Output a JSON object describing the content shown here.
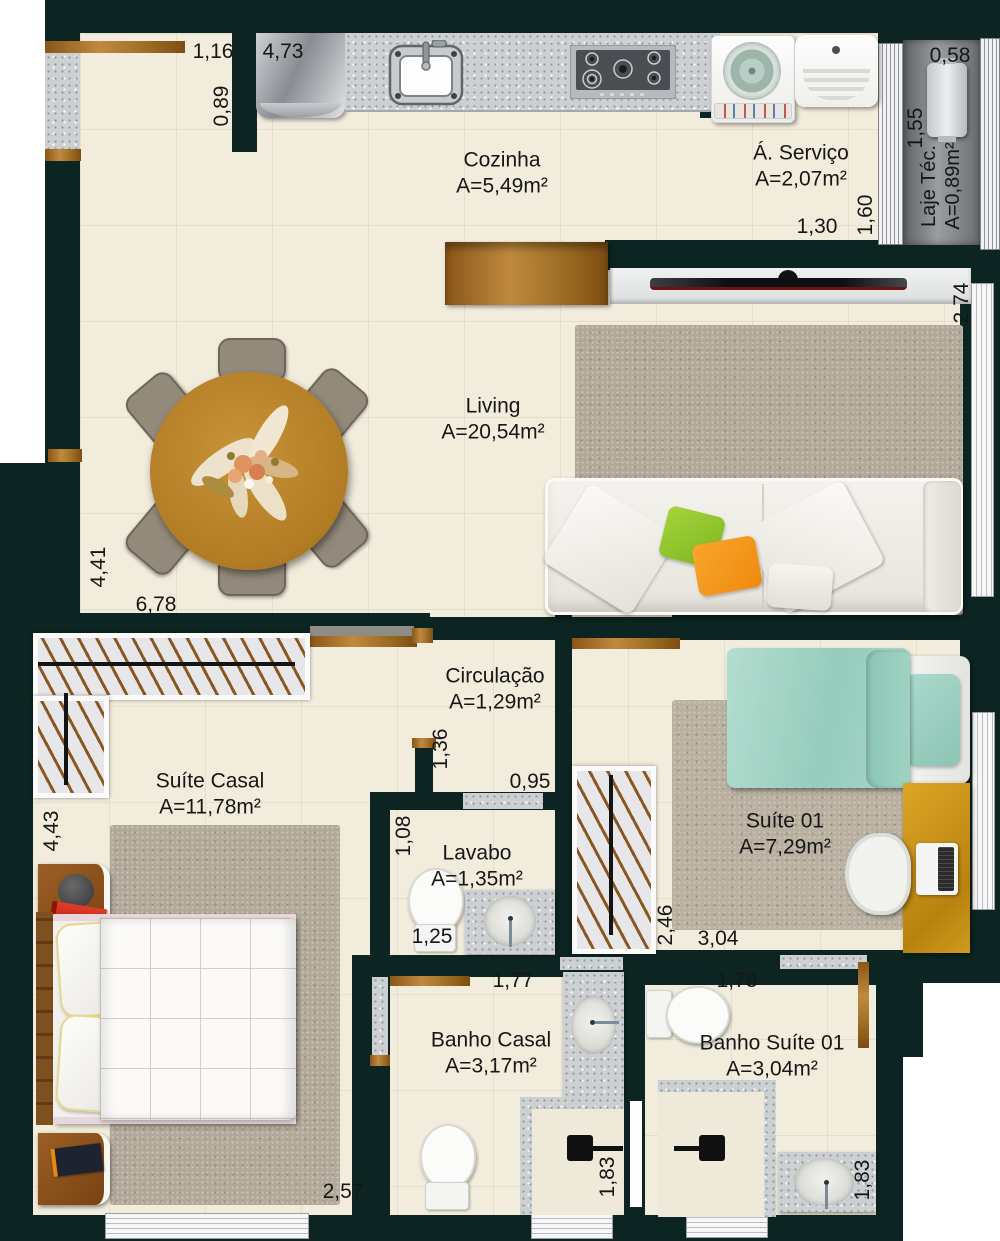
{
  "plan_title": "Apartment floor plan",
  "colors": {
    "wall": "#0c2522",
    "floor": "#f2ecdc",
    "granite": "#ccd0d3",
    "wood": "#b5832f",
    "teal_bed": "#a3d4c7",
    "rug": "#b2a99a",
    "pillow_green": "#95c42e",
    "pillow_orange": "#f49a1b"
  },
  "rooms": [
    {
      "name": "Cozinha",
      "area": "A=5,49m²"
    },
    {
      "name": "Á. Serviço",
      "area": "A=2,07m²"
    },
    {
      "name": "Laje Téc.",
      "area": "A=0,89m²"
    },
    {
      "name": "Living",
      "area": "A=20,54m²"
    },
    {
      "name": "Circulação",
      "area": "A=1,29m²"
    },
    {
      "name": "Suíte Casal",
      "area": "A=11,78m²"
    },
    {
      "name": "Lavabo",
      "area": "A=1,35m²"
    },
    {
      "name": "Suíte 01",
      "area": "A=7,29m²"
    },
    {
      "name": "Banho Casal",
      "area": "A=3,17m²"
    },
    {
      "name": "Banho Suíte 01",
      "area": "A=3,04m²"
    }
  ],
  "dims": {
    "kitchen_left_width": "1,16",
    "kitchen_width": "4,73",
    "kitchen_left_depth": "0,89",
    "laje_width": "0,58",
    "laje_height": "1,55",
    "servico_height": "1,60",
    "servico_width": "1,30",
    "living_window": "2,74",
    "living_height": "4,41",
    "living_width": "6,78",
    "suite_casal_height": "4,43",
    "circulacao_depth": "1,36",
    "lavabo_width": "0,95",
    "lavabo_depth": "1,08",
    "lavabo_width2": "1,25",
    "closet_height": "2,46",
    "suite01_width": "3,04",
    "banho_casal_width": "1,77",
    "banho_suite_width": "1,78",
    "banho_casal_height": "1,83",
    "banho_suite_height": "1,83",
    "suite_casal_width": "2,57"
  }
}
